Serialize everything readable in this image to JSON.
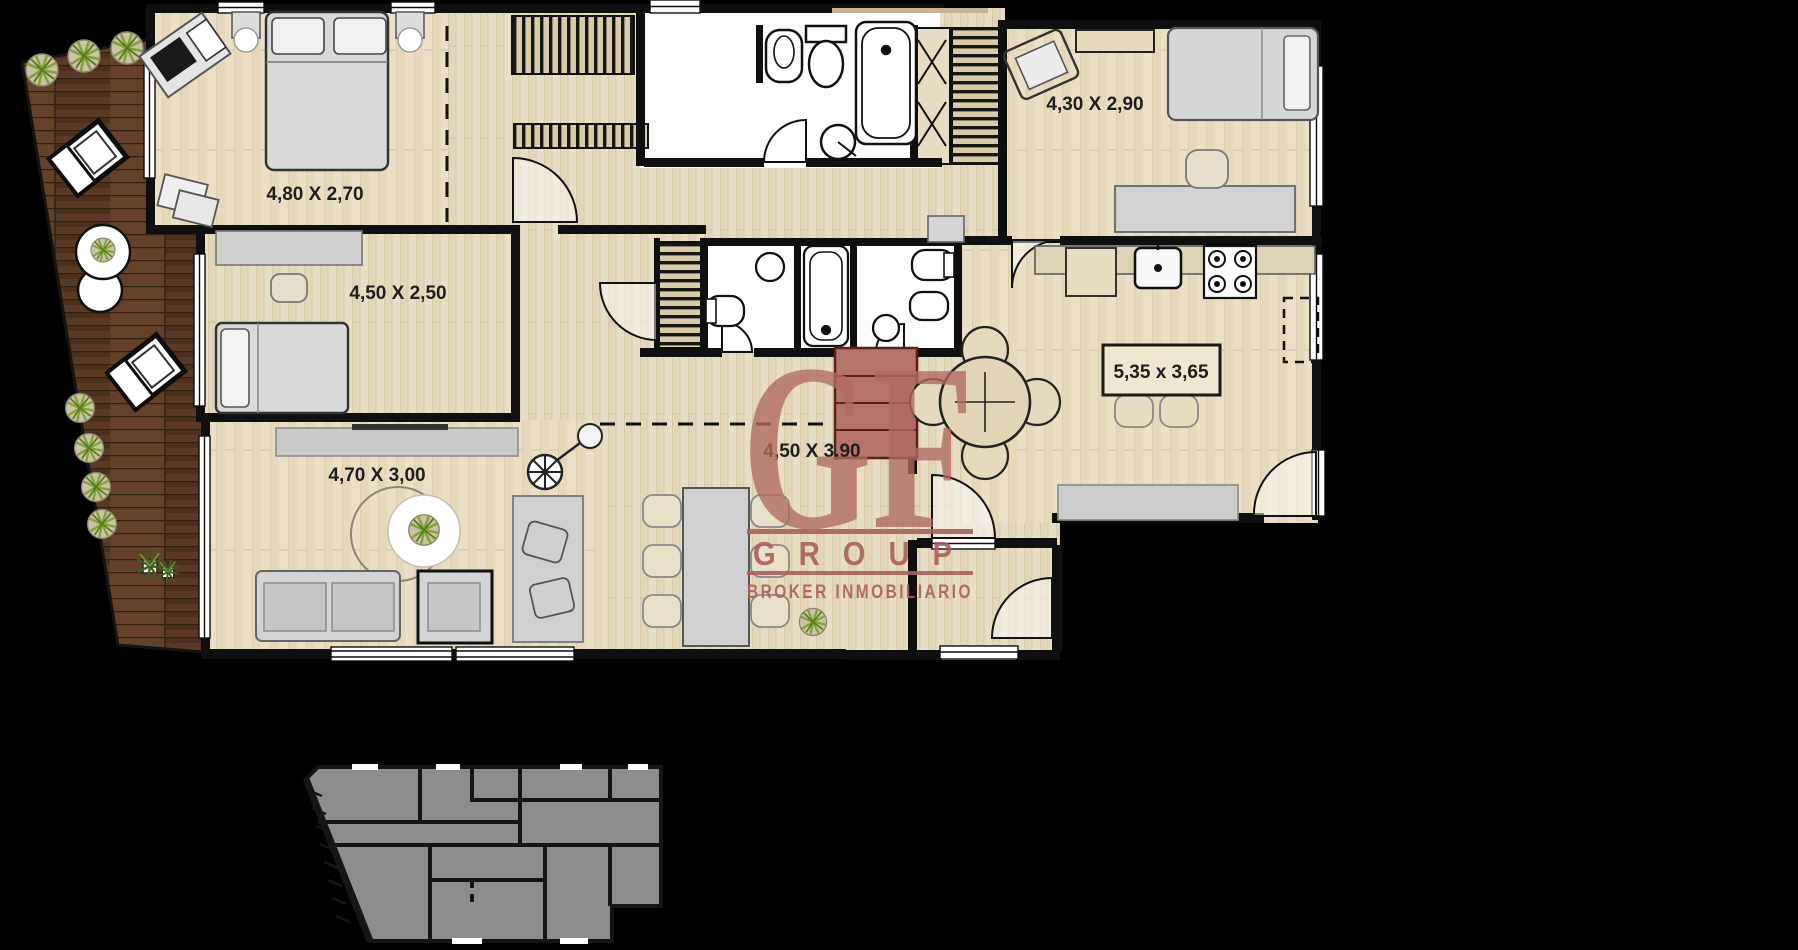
{
  "watermark": {
    "initials": "GF",
    "group_label": "GROUP",
    "tagline": "BROKER INMOBILIARIO",
    "color": "#a9605b"
  },
  "rooms": [
    {
      "id": "bedroom-1",
      "label": "4,80 X 2,70"
    },
    {
      "id": "bedroom-2",
      "label": "4,50 X 2,50"
    },
    {
      "id": "bedroom-3",
      "label": "4,30 X 2,90"
    },
    {
      "id": "living-room",
      "label": "4,70 X 3,00"
    },
    {
      "id": "dining-room",
      "label": "4,50 X 3,90"
    },
    {
      "id": "kitchen-island",
      "label": "5,35 x 3,65"
    }
  ],
  "colors": {
    "background": "#000000",
    "floor_wood": "#e8ddc5",
    "terrace_wood": "#5a3926",
    "walls": "#0f0f0f",
    "fixtures": "#ffffff",
    "furniture": "#d3d3d3",
    "key_plan": "#8d8d8d",
    "watermark_red": "#a9605b"
  }
}
